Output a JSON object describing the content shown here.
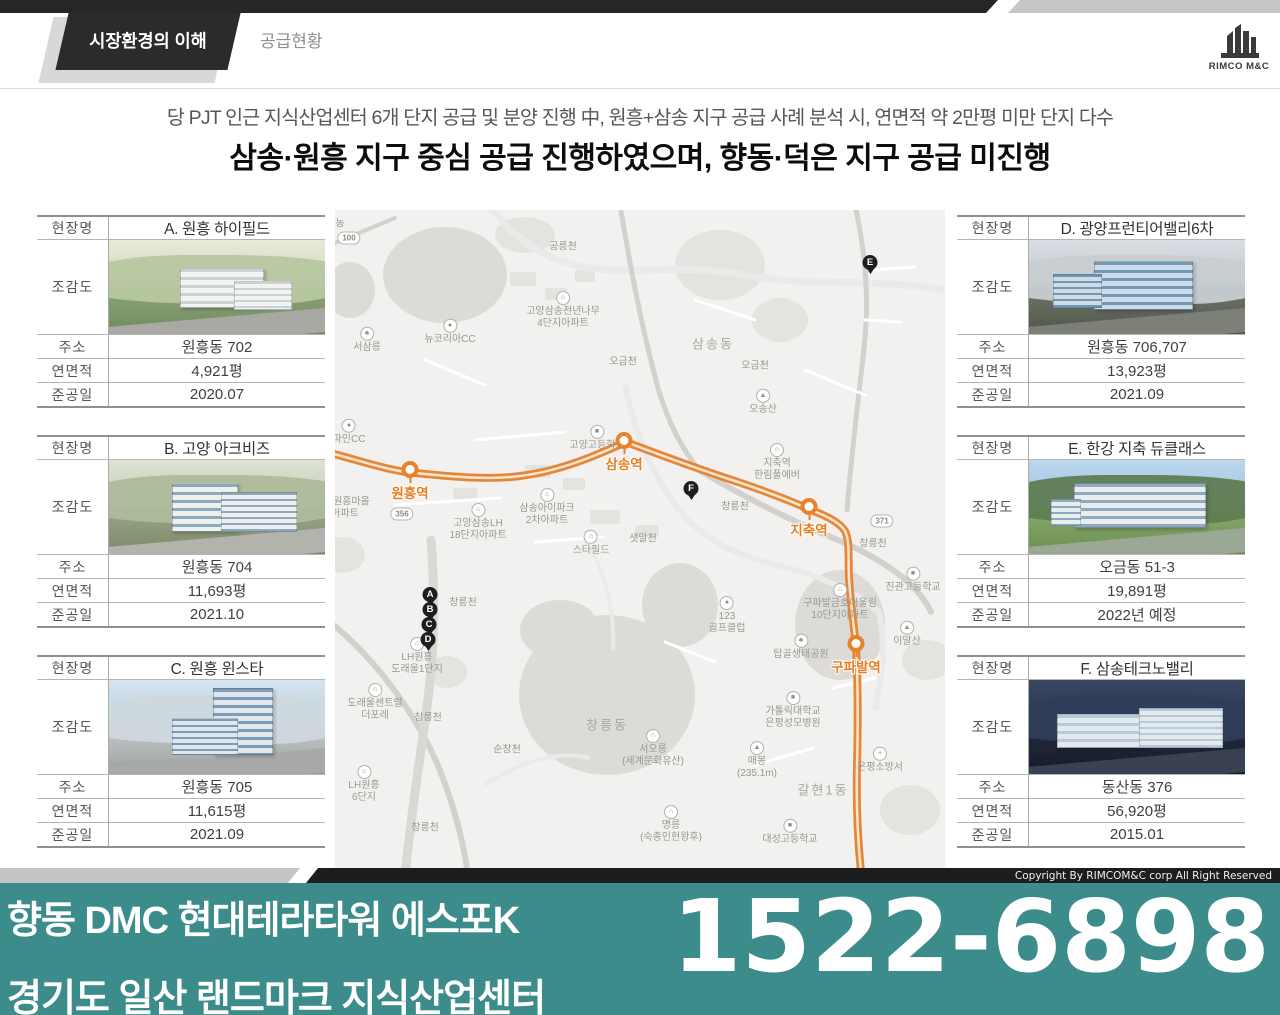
{
  "header": {
    "tab_active": "시장환경의 이해",
    "tab_secondary": "공급현황",
    "logo_text": "RIMCO M&C"
  },
  "headline": {
    "line1": "당 PJT 인근 지식산업센터 6개 단지 공급 및 분양 진행 中, 원흥+삼송 지구 공급 사례 분석 시, 연면적 약 2만평 미만 단지 다수",
    "line2": "삼송·원흥 지구 중심 공급 진행하였으며, 향동·덕은 지구 공급 미진행"
  },
  "table_labels": {
    "site": "현장명",
    "rendering": "조감도",
    "address": "주소",
    "gfa": "연면적",
    "completion": "준공일"
  },
  "cards": [
    {
      "side": "left",
      "variant": "a",
      "name": "A. 원흥 하이필드",
      "address": "원흥동 702",
      "gfa": "4,921평",
      "completion": "2020.07",
      "scene": {
        "sky1": "#e9ead8",
        "sky2": "#cfd8bc",
        "ground": "#8fa47a",
        "ground2": "#6d8a5e",
        "hill": "#b7c7a0",
        "bldg": "#f3f4f1",
        "win": "#c9d3d6",
        "road": "#a9a9a3"
      }
    },
    {
      "side": "left",
      "variant": "b",
      "name": "B. 고양 아크비즈",
      "address": "원흥동 704",
      "gfa": "11,693평",
      "completion": "2021.10",
      "scene": {
        "sky1": "#dfe3d5",
        "sky2": "#c2ccb4",
        "ground": "#9aa585",
        "ground2": "#7c8a6a",
        "hill": "#aebc9a",
        "bldg": "#eef0ee",
        "win": "#8fa8bc",
        "road": "#b3b3ad"
      }
    },
    {
      "side": "left",
      "variant": "c",
      "name": "C. 원흥 윈스타",
      "address": "원흥동 705",
      "gfa": "11,615평",
      "completion": "2021.09",
      "scene": {
        "sky1": "#d6e4ee",
        "sky2": "#bcd2e2",
        "ground": "#c3c8c6",
        "ground2": "#9aa1a0",
        "hill": "#cdd8de",
        "bldg": "#dfe7ec",
        "win": "#7e9cb8",
        "road": "#a7aaa9"
      }
    },
    {
      "side": "right",
      "variant": "d",
      "name": "D. 광양프런티어밸리6차",
      "address": "원흥동 706,707",
      "gfa": "13,923평",
      "completion": "2021.09",
      "scene": {
        "sky1": "#d9dee2",
        "sky2": "#c2cbd2",
        "ground": "#6f7568",
        "ground2": "#51564b",
        "hill": "#c7cdd1",
        "bldg": "#cfdbe4",
        "win": "#6f98b8",
        "road": "#7c8076"
      }
    },
    {
      "side": "right",
      "variant": "e",
      "name": "E. 한강 지축 듀클래스",
      "address": "오금동 51-3",
      "gfa": "19,891평",
      "completion": "2022년 예정",
      "scene": {
        "sky1": "#bcd7ee",
        "sky2": "#9fc4e0",
        "ground": "#8aa86c",
        "ground2": "#6b8f51",
        "hill": "#5f7d53",
        "bldg": "#e8edf0",
        "win": "#90aabb",
        "road": "#9aa894"
      }
    },
    {
      "side": "right",
      "variant": "f",
      "name": "F. 삼송테크노밸리",
      "address": "동산동 376",
      "gfa": "56,920평",
      "completion": "2015.01",
      "scene": {
        "sky1": "#3a4763",
        "sky2": "#2a3650",
        "ground": "#232a3c",
        "ground2": "#161b29",
        "hill": "#303d58",
        "bldg": "#e3e9ee",
        "win": "#b8c9d8",
        "road": "#3a4152"
      }
    }
  ],
  "map": {
    "colors": {
      "route": "#e5873a",
      "route_inner": "#faf0dd",
      "station": "#e8822a",
      "station_text": "#e87d1e",
      "pin": "#1e1e1e"
    },
    "stations": [
      {
        "name": "원흥역",
        "x": 75,
        "y": 262
      },
      {
        "name": "삼송역",
        "x": 289,
        "y": 233
      },
      {
        "name": "지축역",
        "x": 474,
        "y": 299
      },
      {
        "name": "구파발역",
        "x": 521,
        "y": 436
      }
    ],
    "pins": [
      {
        "letter": "A",
        "x": 95,
        "y": 386
      },
      {
        "letter": "B",
        "x": 95,
        "y": 401
      },
      {
        "letter": "C",
        "x": 94,
        "y": 416
      },
      {
        "letter": "D",
        "x": 93,
        "y": 431
      },
      {
        "letter": "E",
        "x": 535,
        "y": 54
      },
      {
        "letter": "F",
        "x": 356,
        "y": 280
      }
    ],
    "badges": [
      {
        "text": "100",
        "x": 14,
        "y": 28
      },
      {
        "text": "356",
        "x": 67,
        "y": 304
      },
      {
        "text": "371",
        "x": 547,
        "y": 311
      }
    ],
    "labels": [
      {
        "text": "농",
        "x": 5,
        "y": 14
      },
      {
        "text": "공릉천",
        "x": 228,
        "y": 37
      },
      {
        "text": "고양삼송천년나무\n4단지아파트",
        "x": 228,
        "y": 100,
        "icon": "apt"
      },
      {
        "text": "뉴코리아CC",
        "x": 115,
        "y": 122,
        "icon": "golf"
      },
      {
        "text": "서삼릉",
        "x": 32,
        "y": 130,
        "icon": "tree"
      },
      {
        "text": "삼송동",
        "x": 378,
        "y": 134,
        "district": true
      },
      {
        "text": "오금천",
        "x": 288,
        "y": 152
      },
      {
        "text": "오금천",
        "x": 420,
        "y": 156
      },
      {
        "text": "오송산",
        "x": 428,
        "y": 192,
        "icon": "mtn"
      },
      {
        "text": "파인CC",
        "x": 14,
        "y": 222,
        "icon": "golf"
      },
      {
        "text": "고양고등학교",
        "x": 262,
        "y": 228,
        "icon": "school"
      },
      {
        "text": "지축역\n한림풀에버",
        "x": 442,
        "y": 252,
        "icon": "apt"
      },
      {
        "text": "삼송아이파크\n2차아파트",
        "x": 212,
        "y": 297,
        "icon": "apt"
      },
      {
        "text": "LH원흥마을\n아파트",
        "x": 10,
        "y": 298
      },
      {
        "text": "고양삼송LH\n18단지아파트",
        "x": 143,
        "y": 312,
        "icon": "apt"
      },
      {
        "text": "창릉천",
        "x": 400,
        "y": 297
      },
      {
        "text": "창릉천",
        "x": 538,
        "y": 334
      },
      {
        "text": "샛말천",
        "x": 308,
        "y": 329
      },
      {
        "text": "스타필드",
        "x": 256,
        "y": 333,
        "icon": "apt"
      },
      {
        "text": "창릉천",
        "x": 128,
        "y": 393
      },
      {
        "text": "LH원흥\n도래울1단지",
        "x": 82,
        "y": 446,
        "icon": "apt"
      },
      {
        "text": "도래울센트럴\n더포레",
        "x": 40,
        "y": 492,
        "icon": "apt"
      },
      {
        "text": "창릉천",
        "x": 93,
        "y": 508
      },
      {
        "text": "순창천",
        "x": 172,
        "y": 540
      },
      {
        "text": "LH원흥\n6단지",
        "x": 29,
        "y": 574,
        "icon": "apt"
      },
      {
        "text": "창릉천",
        "x": 90,
        "y": 618
      },
      {
        "text": "창릉동",
        "x": 272,
        "y": 515,
        "district": true
      },
      {
        "text": "서오릉\n(세계문화유산)",
        "x": 318,
        "y": 538,
        "icon": "heritage"
      },
      {
        "text": "매봉\n(235.1m)",
        "x": 422,
        "y": 550,
        "icon": "mtn"
      },
      {
        "text": "명릉\n(숙종인현왕후)",
        "x": 336,
        "y": 614,
        "icon": "heritage"
      },
      {
        "text": "123\n골프클럽",
        "x": 392,
        "y": 405,
        "icon": "golf"
      },
      {
        "text": "탑골생태공원",
        "x": 466,
        "y": 437,
        "icon": "tree"
      },
      {
        "text": "구파발금호어울림\n10단지아파트",
        "x": 505,
        "y": 392,
        "icon": "apt"
      },
      {
        "text": "진관고등학교",
        "x": 578,
        "y": 370,
        "icon": "school"
      },
      {
        "text": "이말산",
        "x": 572,
        "y": 424,
        "icon": "mtn"
      },
      {
        "text": "가톨릭대학교\n은평성모병원",
        "x": 458,
        "y": 500,
        "icon": "school"
      },
      {
        "text": "갈현1동",
        "x": 488,
        "y": 580,
        "district": true
      },
      {
        "text": "대성고등학교",
        "x": 455,
        "y": 622,
        "icon": "school"
      },
      {
        "text": "은평소방서",
        "x": 545,
        "y": 550,
        "icon": "fire"
      }
    ]
  },
  "footer": {
    "copyright": "Copyright By RIMCOM&C corp All Right Reserved",
    "line1": "향동 DMC 현대테라타워 에스포K",
    "line2": "경기도 일산 랜드마크 지식산업센터",
    "phone": "1522-6898",
    "banner_color": "#3d8c8c"
  }
}
